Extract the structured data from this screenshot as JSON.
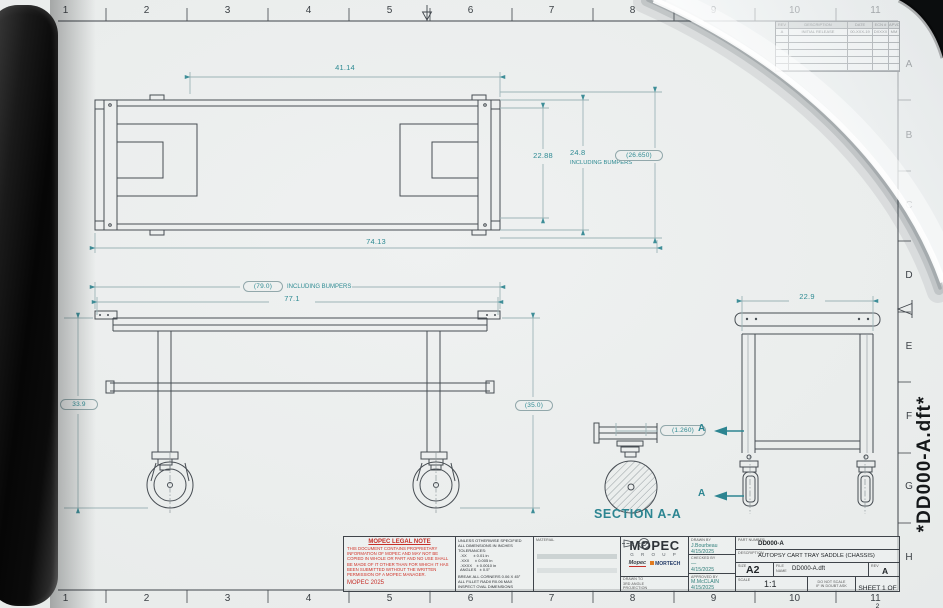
{
  "colors": {
    "dimension_text": "#2f8b93",
    "drawing_line": "#474d53",
    "legal_red": "#c62f28",
    "paper": "#e9eceb",
    "section_label": "#2c8591"
  },
  "page": {
    "vertical_file_label": "*DD000-A.dft*"
  },
  "rulers": {
    "top": [
      "1",
      "2",
      "3",
      "4",
      "5",
      "6",
      "7",
      "8",
      "9",
      "10",
      "11"
    ],
    "bottom": [
      "1",
      "2",
      "3",
      "4",
      "5",
      "6",
      "7",
      "8",
      "9",
      "10",
      "11"
    ],
    "right": [
      "A",
      "B",
      "C",
      "D",
      "E",
      "F",
      "G",
      "H"
    ]
  },
  "revision_table": {
    "headers": [
      "REV",
      "DESCRIPTION",
      "DATE",
      "ECN #",
      "APVD"
    ],
    "rows": [
      {
        "rev": "A",
        "description": "INITIAL RELEASE",
        "date": "00-XXX-19",
        "ecn": "DXXXX",
        "apvd": "MM"
      }
    ],
    "empty_rows": 5
  },
  "views": {
    "top": {
      "dim_inner_length": "41.14",
      "dim_overall_length": "74.13",
      "dim_width": "22.88",
      "dim_width_bumpers": "24.8",
      "dim_width_bumpers_note": "INCLUDING BUMPERS",
      "dim_width_ref": "(26.650)"
    },
    "front": {
      "dim_length_bumpers": "(79.0)",
      "dim_length_bumpers_note": "INCLUDING BUMPERS",
      "dim_length": "77.1",
      "dim_height": "33.9",
      "dim_height_ref": "(35.0)"
    },
    "end": {
      "dim_width": "22.9",
      "section_arrow_label": "A"
    },
    "section": {
      "title": "SECTION A-A",
      "dim_wheel_width": "(1.260)"
    }
  },
  "title_block": {
    "legal": {
      "title": "MOPEC LEGAL NOTE",
      "body": "THIS DOCUMENT CONTAINS PROPRIETARY INFORMATION OF MOPEC AND MAY NOT BE COPIED IN WHOLE OR PART AND NO USE SHALL BE MADE OF IT OTHER THAN FOR WHICH IT HAS BEEN SUBMITTED WITHOUT THE WRITTEN PERMISSION OF A MOPEC MANAGER.",
      "footer": "MOPEC 2025"
    },
    "tolerances": [
      "UNLESS OTHERWISE SPECIFIED",
      "ALL DIMENSIONS IN INCHES",
      "TOLERANCES:",
      "  .XX      ± 0.01 in",
      "  .XXX     ± 0.005 in",
      "  .XXXX    ± 0.0010 in",
      "  ANGLES   ± 0.5°",
      "",
      "BREAK ALL CORNERS 0.06 X 45°",
      "ALL FILLET RADII R0.06 MAX",
      "INSPECT OVAL DIMENSIONS"
    ],
    "material_label": "MATERIAL",
    "logo": {
      "brand": "MOPEC",
      "brand_sub": "G R O U P",
      "brand2": "Mopec",
      "brand3": "MORTECH",
      "projection_note": "DRAWN TO 3RD ANGLE PROJECTION"
    },
    "signatures": [
      {
        "label": "DRAWN BY",
        "name": "J.Bourbeau",
        "date": "4/15/2025"
      },
      {
        "label": "CHECKED BY",
        "name": "—",
        "date": "4/15/2025"
      },
      {
        "label": "APPROVED BY",
        "name": "M.McCLAIN",
        "date": "4/15/2025"
      }
    ],
    "info": {
      "part_label": "PART NUMBER",
      "part_number": "DD000-A",
      "desc_label": "DESCRIPTION",
      "description": "AUTOPSY CART TRAY SADDLE (CHASSIS)",
      "size_label": "SIZE",
      "size": "A2",
      "file_label": "FILE NAME",
      "file_name": "DD000-A.dft",
      "rev_label": "REV",
      "rev": "A",
      "scale_label": "SCALE",
      "scale": "1:1",
      "dns1": "DO NOT SCALE",
      "dns2": "IF IN DOUBT ASK",
      "sheet": "SHEET 1 OF 2"
    }
  }
}
